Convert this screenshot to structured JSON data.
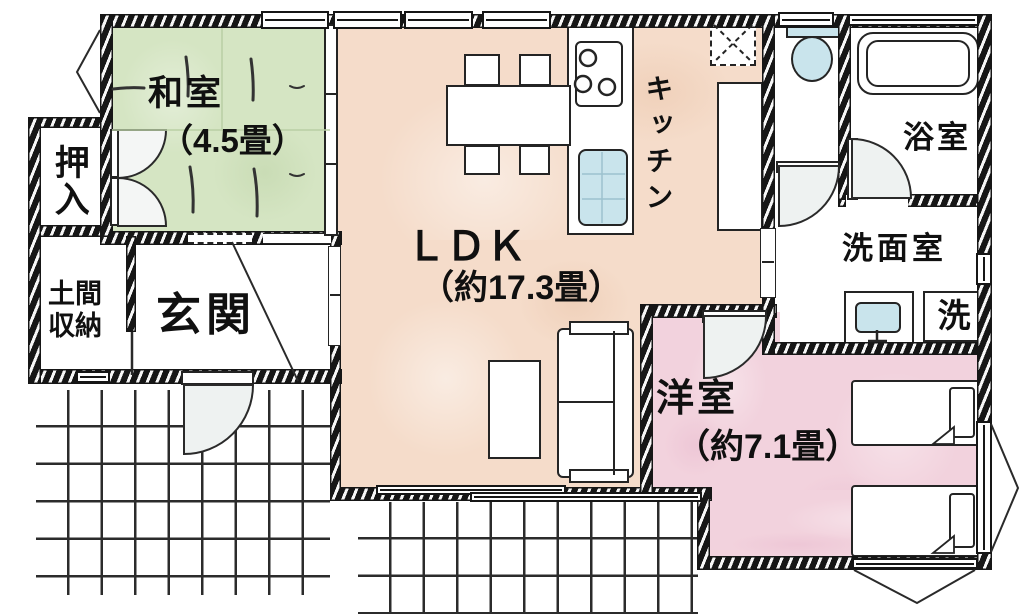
{
  "plan_type": "floor-plan",
  "rooms": {
    "washitsu": {
      "name": "和室",
      "size": "（4.5畳）"
    },
    "oshiire": {
      "name": "押入"
    },
    "doma": {
      "line1": "土間",
      "line2": "収納"
    },
    "genkan": {
      "name": "玄関"
    },
    "ldk": {
      "name": "ＬＤＫ",
      "size": "（約17.3畳）"
    },
    "kitchen": {
      "name": "キッチン"
    },
    "bath": {
      "name": "浴室"
    },
    "washroom": {
      "name": "洗面室"
    },
    "laundry": {
      "name": "洗"
    },
    "yoshitsu": {
      "name": "洋室",
      "size": "（約7.1畳）"
    }
  },
  "colors": {
    "tatami_green": "#d5e5c3",
    "ldk_wood": "#f5dcca",
    "yoshitsu_pink": "#f2d2dd",
    "fixture_blue": "#c9e4ec",
    "wall_black": "#161616"
  }
}
